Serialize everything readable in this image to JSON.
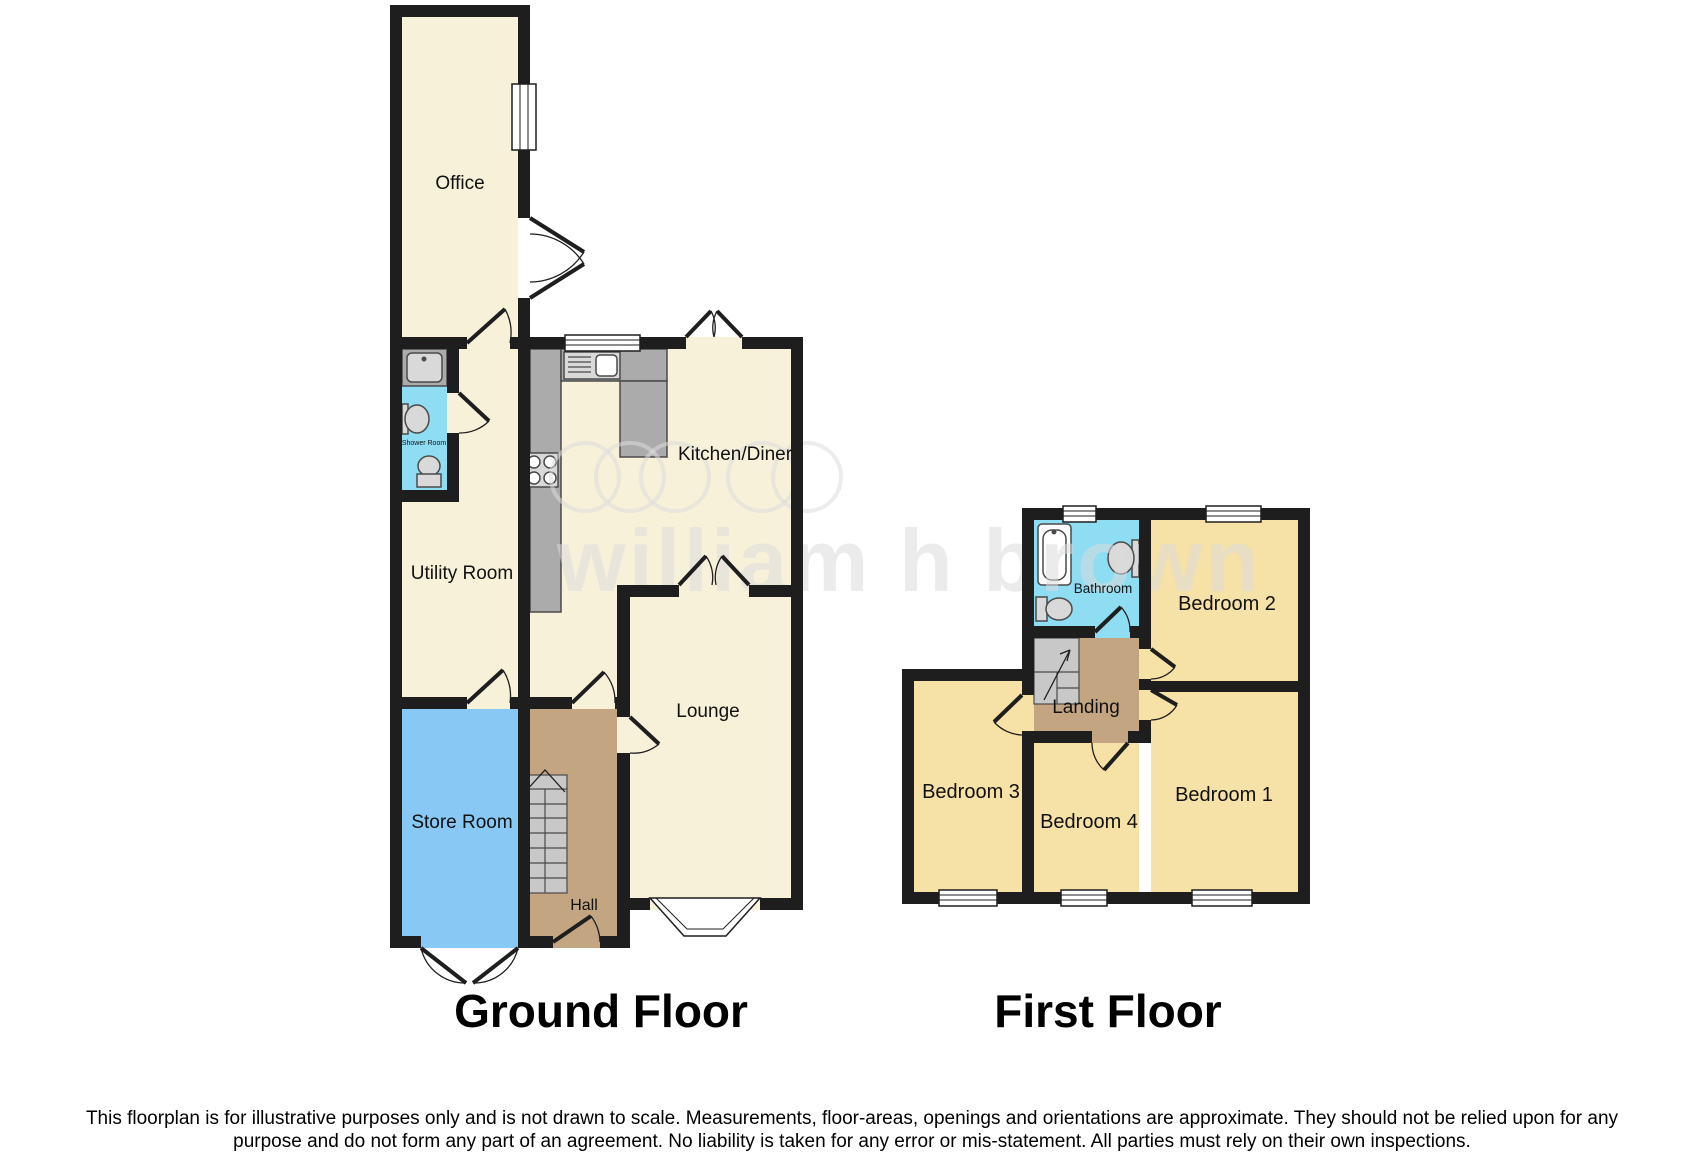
{
  "ground_floor": {
    "title": "Ground Floor",
    "rooms": {
      "office": "Office",
      "shower_room": "Shower Room",
      "utility_room": "Utility Room",
      "kitchen_diner": "Kitchen/Diner",
      "lounge": "Lounge",
      "store_room": "Store Room",
      "hall": "Hall"
    }
  },
  "first_floor": {
    "title": "First Floor",
    "rooms": {
      "bathroom": "Bathroom",
      "bedroom1": "Bedroom 1",
      "bedroom2": "Bedroom 2",
      "bedroom3": "Bedroom 3",
      "bedroom4": "Bedroom 4",
      "landing": "Landing"
    }
  },
  "watermark": {
    "text": "william h brown"
  },
  "disclaimer": {
    "line1": "This floorplan is for illustrative purposes only and is not drawn to scale. Measurements, floor-areas, openings and orientations are approximate. They should not be relied upon for any",
    "line2": "purpose and do not form any part of an agreement. No liability is taken for any error or mis-statement. All parties must rely on their own inspections."
  },
  "colors": {
    "wall": "#1e1e1e",
    "room_cream": "#f7f1da",
    "room_yellow": "#f6e2a6",
    "room_tan": "#c3a681",
    "room_blue": "#87c9f4",
    "room_cyan": "#8eddf3",
    "counter_gray": "#ababab",
    "stair_gray": "#c8c8c8",
    "watermark_gray": "#dcdcdc"
  }
}
